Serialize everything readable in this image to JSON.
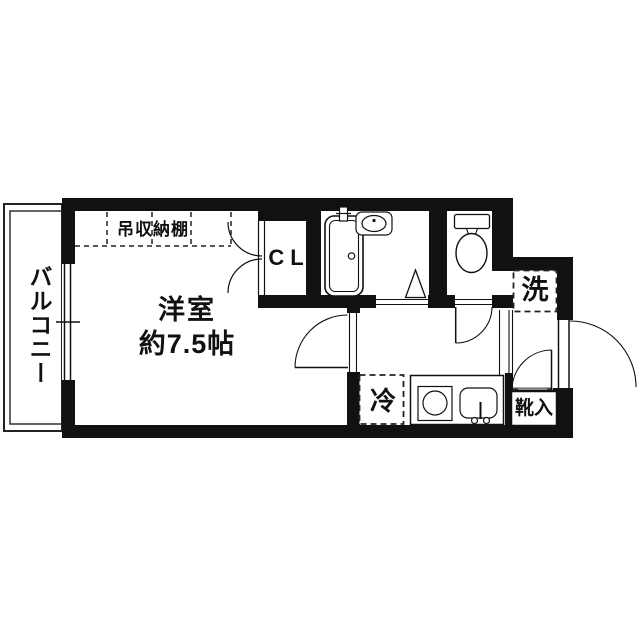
{
  "colors": {
    "line": "#111111",
    "background": "#ffffff",
    "threshold_gray": "#b0b0b0"
  },
  "plan": {
    "balcony": {
      "label": "バルコニー"
    },
    "main_room": {
      "name": "洋室",
      "size": "約7.5帖"
    },
    "hanging_shelf": {
      "label": "吊収納棚"
    },
    "closet": {
      "label": "CL"
    },
    "laundry_space": {
      "label": "洗"
    },
    "refrigerator_space": {
      "label": "冷"
    },
    "shoe_cabinet": {
      "label": "靴入"
    }
  }
}
